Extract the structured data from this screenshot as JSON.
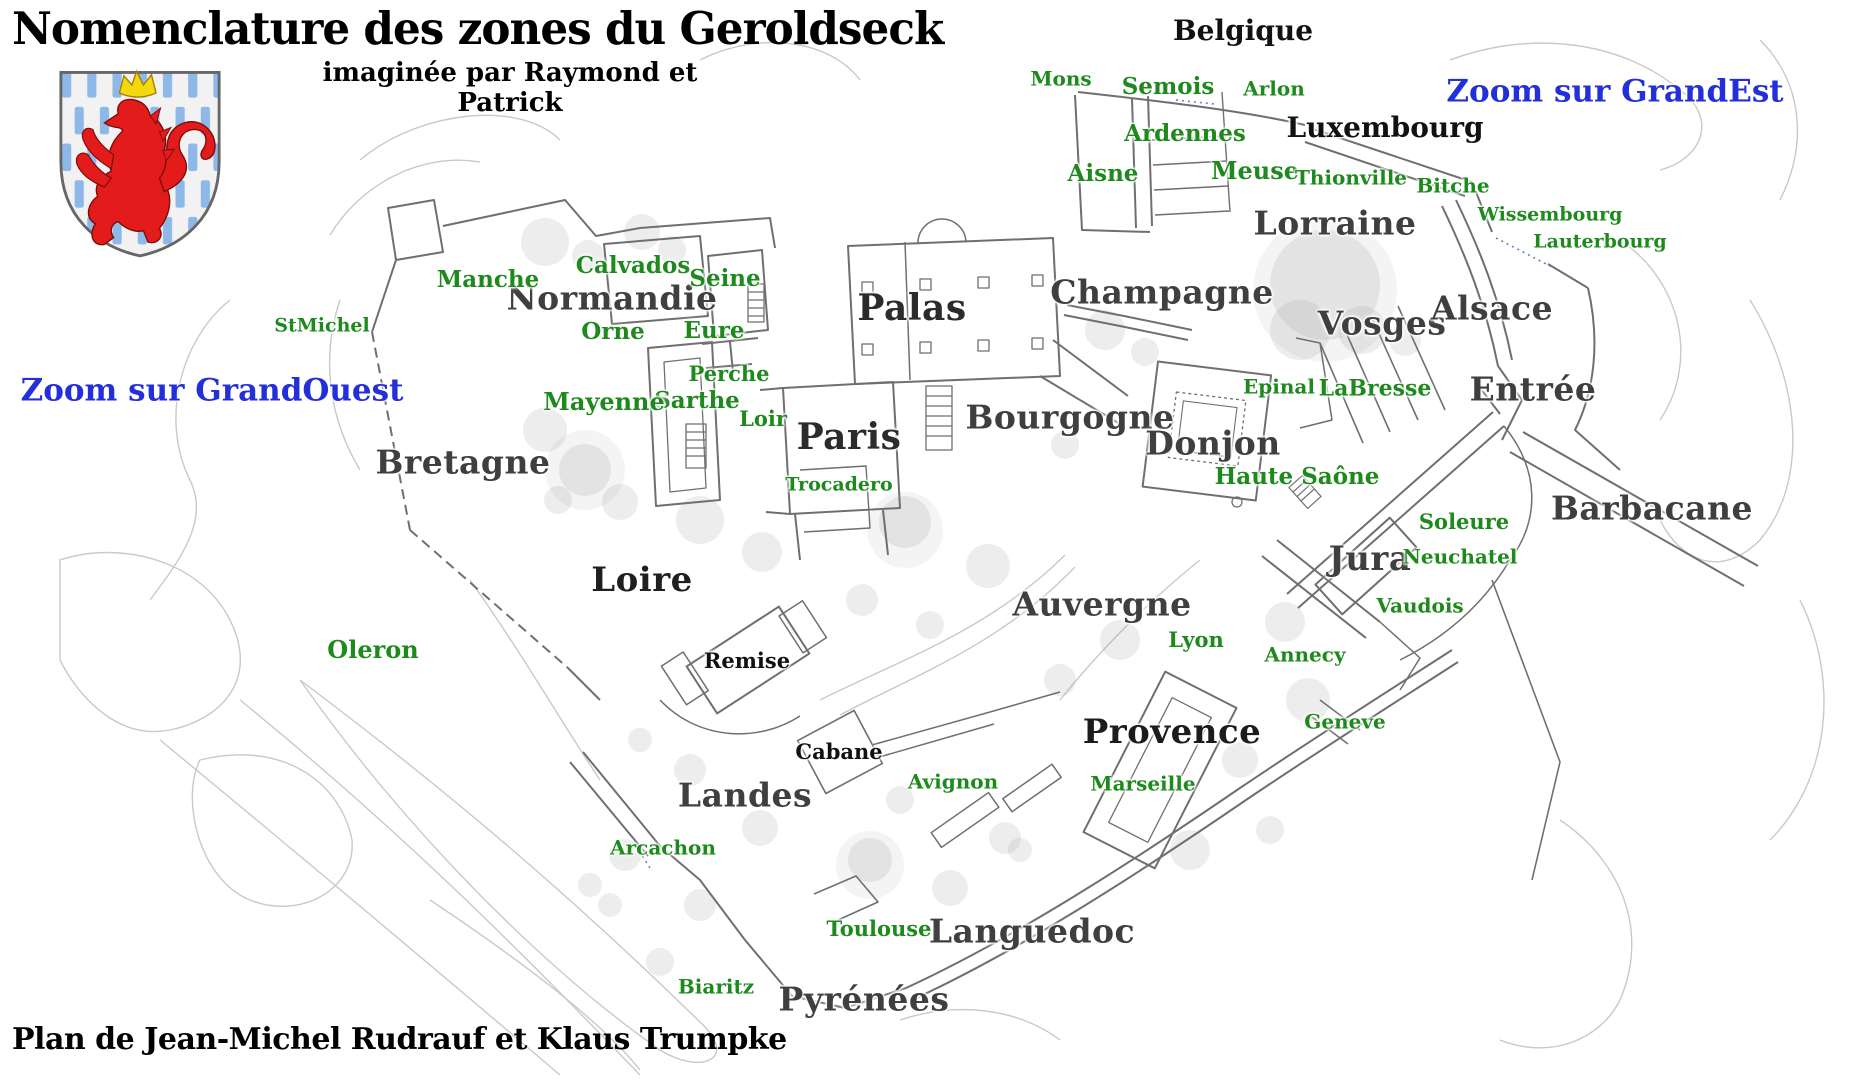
{
  "header": {
    "title": "Nomenclature des zones du Geroldseck",
    "subtitle": "imaginée par Raymond et Patrick",
    "credit": "Plan de Jean-Michel Rudrauf et Klaus Trumpke"
  },
  "colors": {
    "zone_green": "#1e8a1e",
    "region_gray": "#3f3f3f",
    "place_black": "#111111",
    "link_blue": "#2330d9",
    "wall_gray": "#6f6f6f",
    "contour_gray": "#c9c9c9",
    "shield_blue": "#8db8e8",
    "lion_red": "#e41b1b",
    "crown_yellow": "#f2d90f"
  },
  "links": [
    {
      "label": "Zoom sur GrandEst",
      "x": 1615,
      "y": 92,
      "size": 31
    },
    {
      "label": "Zoom sur GrandOuest",
      "x": 212,
      "y": 391,
      "size": 31
    }
  ],
  "map": {
    "region_labels": [
      {
        "text": "Normandie",
        "x": 612,
        "y": 299,
        "size": 33
      },
      {
        "text": "Palas",
        "x": 912,
        "y": 309,
        "size": 36,
        "color": "#2b2b2b"
      },
      {
        "text": "Paris",
        "x": 849,
        "y": 438,
        "size": 36,
        "color": "#2b2b2b"
      },
      {
        "text": "Bretagne",
        "x": 463,
        "y": 463,
        "size": 33
      },
      {
        "text": "Loire",
        "x": 642,
        "y": 581,
        "size": 34,
        "color": "#1f1f1f"
      },
      {
        "text": "Champagne",
        "x": 1162,
        "y": 293,
        "size": 33
      },
      {
        "text": "Bourgogne",
        "x": 1070,
        "y": 418,
        "size": 33
      },
      {
        "text": "Donjon",
        "x": 1213,
        "y": 444,
        "size": 33
      },
      {
        "text": "Lorraine",
        "x": 1335,
        "y": 224,
        "size": 33
      },
      {
        "text": "Vosges",
        "x": 1382,
        "y": 324,
        "size": 33
      },
      {
        "text": "Alsace",
        "x": 1492,
        "y": 309,
        "size": 33
      },
      {
        "text": "Entrée",
        "x": 1533,
        "y": 390,
        "size": 33
      },
      {
        "text": "Barbacane",
        "x": 1652,
        "y": 509,
        "size": 33
      },
      {
        "text": "Jura",
        "x": 1370,
        "y": 560,
        "size": 34
      },
      {
        "text": "Auvergne",
        "x": 1102,
        "y": 605,
        "size": 33
      },
      {
        "text": "Provence",
        "x": 1172,
        "y": 733,
        "size": 34,
        "color": "#1c1c1c"
      },
      {
        "text": "Languedoc",
        "x": 1032,
        "y": 932,
        "size": 33
      },
      {
        "text": "Pyrénées",
        "x": 864,
        "y": 1000,
        "size": 33
      },
      {
        "text": "Landes",
        "x": 745,
        "y": 796,
        "size": 33
      }
    ],
    "place_labels": [
      {
        "text": "Belgique",
        "x": 1243,
        "y": 31,
        "size": 28
      },
      {
        "text": "Luxembourg",
        "x": 1385,
        "y": 128,
        "size": 28
      },
      {
        "text": "Remise",
        "x": 747,
        "y": 661,
        "size": 21
      },
      {
        "text": "Cabane",
        "x": 839,
        "y": 752,
        "size": 21
      }
    ],
    "zone_labels": [
      {
        "text": "Mons",
        "x": 1061,
        "y": 79,
        "size": 20
      },
      {
        "text": "Semois",
        "x": 1168,
        "y": 87,
        "size": 23
      },
      {
        "text": "Arlon",
        "x": 1274,
        "y": 89,
        "size": 20
      },
      {
        "text": "Ardennes",
        "x": 1185,
        "y": 134,
        "size": 23
      },
      {
        "text": "Aisne",
        "x": 1103,
        "y": 174,
        "size": 23
      },
      {
        "text": "Meuse",
        "x": 1255,
        "y": 171,
        "size": 24
      },
      {
        "text": "Thionville",
        "x": 1351,
        "y": 178,
        "size": 20
      },
      {
        "text": "Bitche",
        "x": 1453,
        "y": 186,
        "size": 20
      },
      {
        "text": "Wissembourg",
        "x": 1550,
        "y": 215,
        "size": 19
      },
      {
        "text": "Lauterbourg",
        "x": 1600,
        "y": 242,
        "size": 19
      },
      {
        "text": "Calvados",
        "x": 633,
        "y": 266,
        "size": 23
      },
      {
        "text": "Seine",
        "x": 725,
        "y": 279,
        "size": 23
      },
      {
        "text": "Manche",
        "x": 488,
        "y": 280,
        "size": 23
      },
      {
        "text": "Orne",
        "x": 613,
        "y": 332,
        "size": 23
      },
      {
        "text": "Eure",
        "x": 714,
        "y": 331,
        "size": 23
      },
      {
        "text": "Perche",
        "x": 729,
        "y": 374,
        "size": 21
      },
      {
        "text": "Sarthe",
        "x": 697,
        "y": 401,
        "size": 23
      },
      {
        "text": "Mayenne",
        "x": 604,
        "y": 402,
        "size": 24
      },
      {
        "text": "Loir",
        "x": 763,
        "y": 419,
        "size": 21
      },
      {
        "text": "Trocadero",
        "x": 839,
        "y": 485,
        "size": 19
      },
      {
        "text": "StMichel",
        "x": 322,
        "y": 326,
        "size": 19
      },
      {
        "text": "Epinal",
        "x": 1279,
        "y": 387,
        "size": 20
      },
      {
        "text": "LaBresse",
        "x": 1375,
        "y": 389,
        "size": 22
      },
      {
        "text": "Haute Saône",
        "x": 1297,
        "y": 477,
        "size": 23
      },
      {
        "text": "Soleure",
        "x": 1464,
        "y": 522,
        "size": 21
      },
      {
        "text": "Neuchatel",
        "x": 1460,
        "y": 557,
        "size": 20
      },
      {
        "text": "Vaudois",
        "x": 1420,
        "y": 606,
        "size": 20
      },
      {
        "text": "Lyon",
        "x": 1196,
        "y": 640,
        "size": 21
      },
      {
        "text": "Annecy",
        "x": 1305,
        "y": 655,
        "size": 20
      },
      {
        "text": "Geneve",
        "x": 1345,
        "y": 722,
        "size": 20
      },
      {
        "text": "Marseille",
        "x": 1143,
        "y": 784,
        "size": 20
      },
      {
        "text": "Avignon",
        "x": 953,
        "y": 782,
        "size": 20
      },
      {
        "text": "Arcachon",
        "x": 663,
        "y": 848,
        "size": 20
      },
      {
        "text": "Toulouse",
        "x": 879,
        "y": 929,
        "size": 21
      },
      {
        "text": "Biaritz",
        "x": 716,
        "y": 987,
        "size": 20
      },
      {
        "text": "Oleron",
        "x": 373,
        "y": 650,
        "size": 24
      }
    ]
  }
}
